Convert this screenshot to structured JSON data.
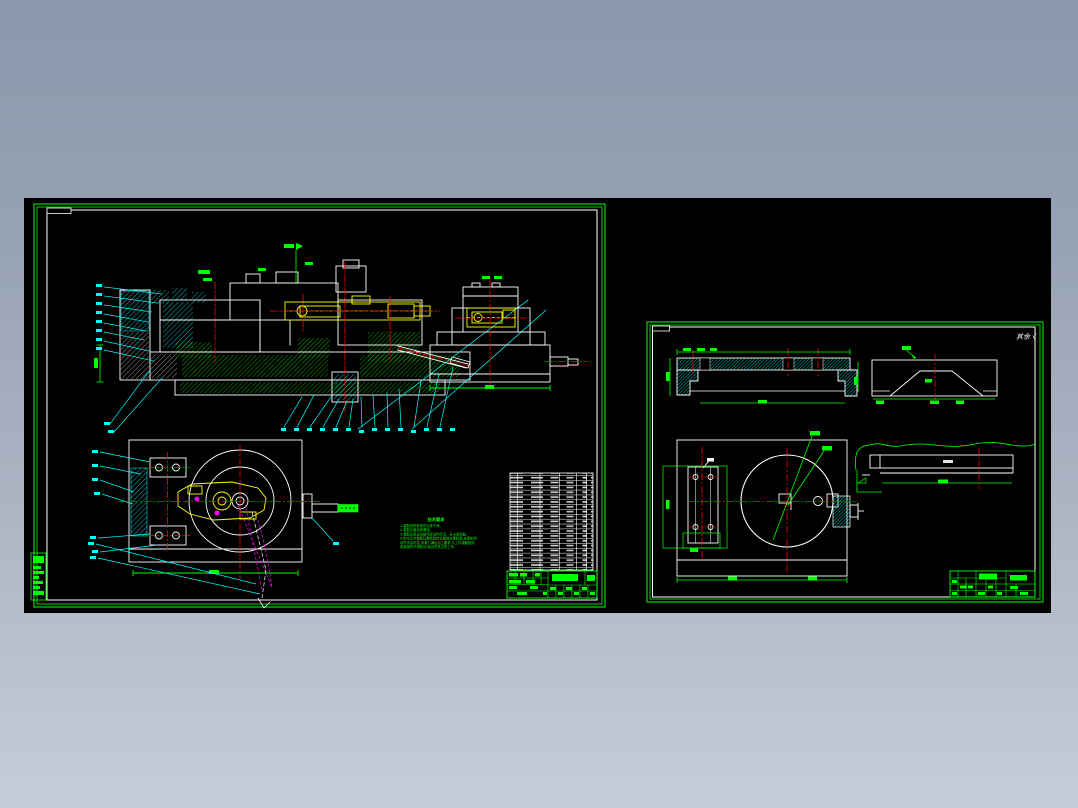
{
  "window": {
    "width": 1078,
    "height": 808
  },
  "background": {
    "top_color": "#8B97AB",
    "bottom_color": "#C6CDD9",
    "canvas_color": "#000000"
  },
  "palette": {
    "green": "#00FF00",
    "cyan": "#00FFFF",
    "red": "#FF0000",
    "yellow": "#FFFF00",
    "magenta": "#FF00FF",
    "white": "#FFFFFF"
  },
  "left_sheet": {
    "notes": {
      "title": "技术要求",
      "lines": [
        "1.装配前所有零件清洗干净。",
        "2.各配合面涂润滑油。",
        "3.装配后各运动部件应动作灵活、无卡滞现象。",
        "4.定位元件装配后需检验定位面的位置精度,夹紧机构",
        "动作灵活可靠,夹紧力满足加工要求,与工件接触良好,",
        "各紧固件不得松动,保证夹具正常工作。"
      ]
    }
  },
  "right_sheet": {
    "surface_note": "其余 √"
  }
}
